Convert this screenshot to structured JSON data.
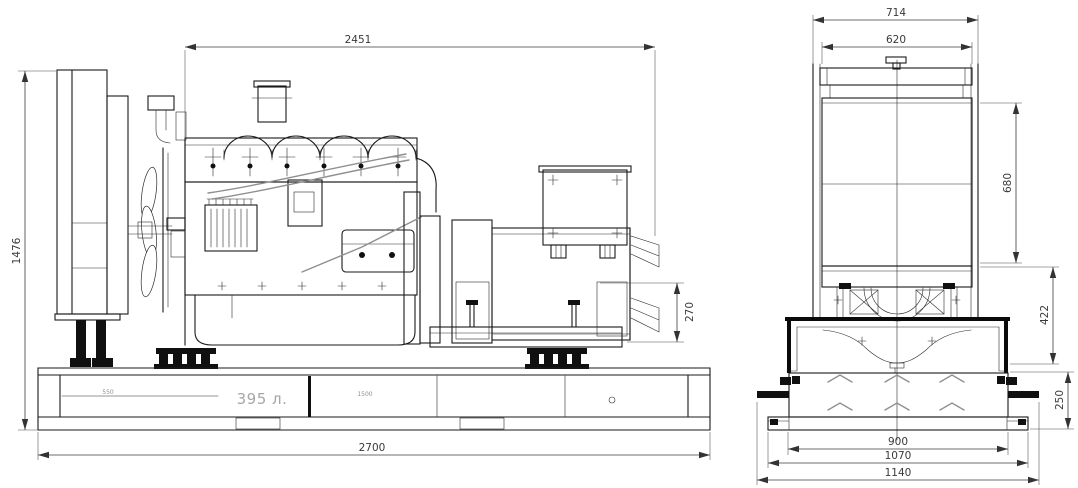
{
  "side_view": {
    "dims": {
      "overall_length": "2451",
      "overall_height": "1476",
      "base_length": "2700",
      "alternator_rear_height": "270"
    },
    "tank": {
      "capacity_label": "395 л.",
      "compartment_left": "550",
      "compartment_mid": "1500"
    }
  },
  "end_view": {
    "dims": {
      "frame_width": "714",
      "core_width": "620",
      "core_height": "680",
      "frame_to_base": "422",
      "base_height": "250",
      "foot_span": "900",
      "plate_width": "1070",
      "overall_width": "1140"
    }
  },
  "colors": {
    "background": "#ffffff",
    "line": "#1a1a1a",
    "dimension_text": "#3a3a3a",
    "faint_text": "#a6a6a6"
  }
}
